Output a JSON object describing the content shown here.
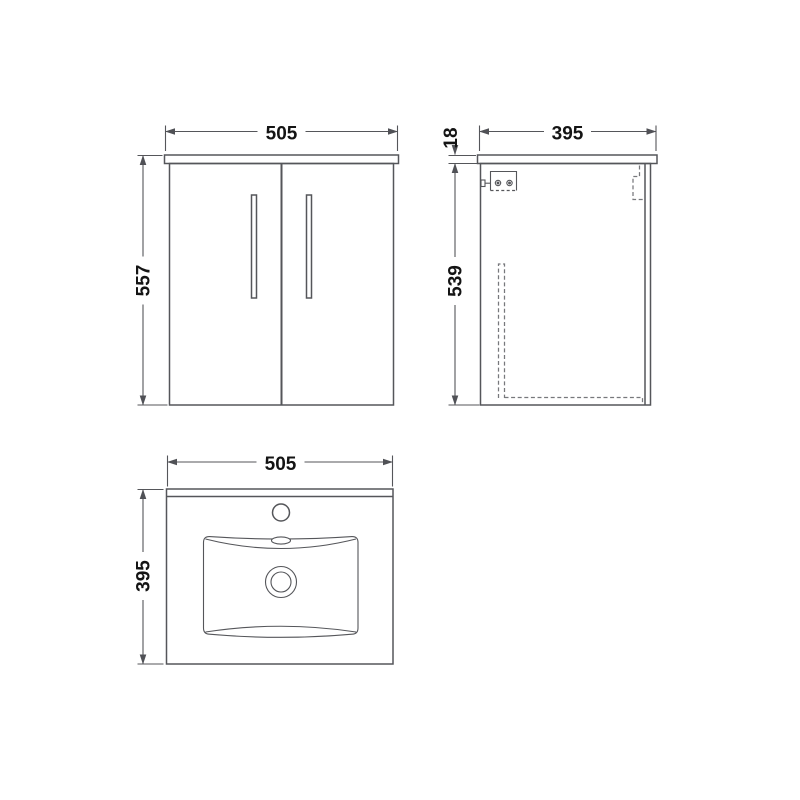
{
  "style": {
    "background": "#ffffff",
    "line_color": "#55565a",
    "hidden_line_color": "#77787c",
    "text_color": "#141414",
    "arrow_color": "#505156"
  },
  "views": {
    "front": {
      "dims": {
        "width": "505",
        "height": "557"
      }
    },
    "side": {
      "dims": {
        "depth": "395",
        "counter_thickness": "18",
        "cabinet_height": "539"
      }
    },
    "plan": {
      "dims": {
        "width": "505",
        "depth": "395"
      }
    }
  }
}
